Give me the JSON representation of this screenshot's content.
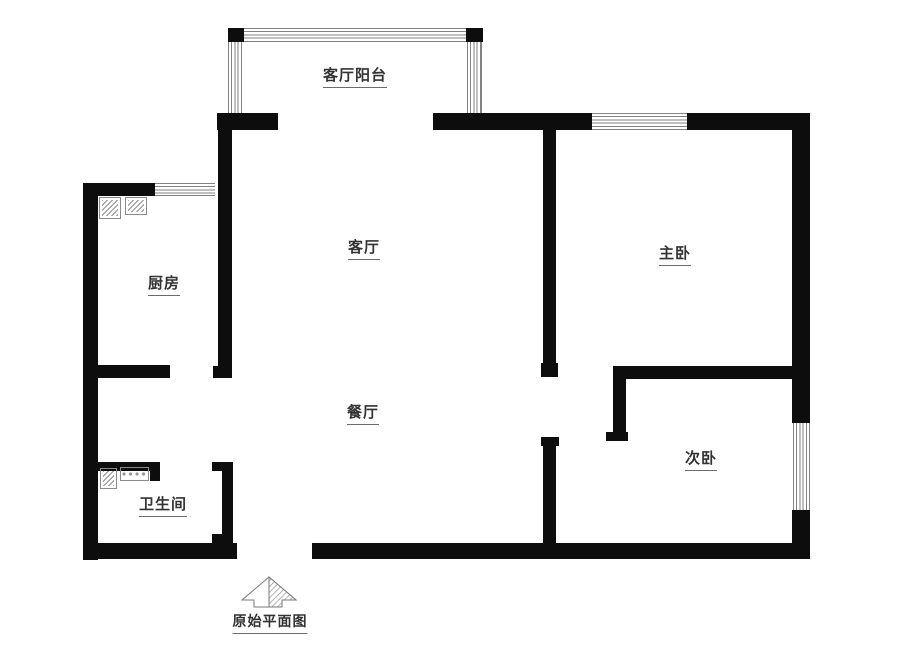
{
  "diagram": {
    "type": "floor-plan",
    "caption": "原始平面图",
    "rooms": [
      {
        "id": "balcony",
        "label": "客厅阳台"
      },
      {
        "id": "living-room",
        "label": "客厅"
      },
      {
        "id": "kitchen",
        "label": "厨房"
      },
      {
        "id": "master-bedroom",
        "label": "主卧"
      },
      {
        "id": "dining-room",
        "label": "餐厅"
      },
      {
        "id": "bathroom",
        "label": "卫生间"
      },
      {
        "id": "second-bedroom",
        "label": "次卧"
      }
    ],
    "colors": {
      "wall": "#0d0d0d",
      "window_line": "#828282",
      "label_text": "#333333",
      "background": "#ffffff"
    }
  }
}
